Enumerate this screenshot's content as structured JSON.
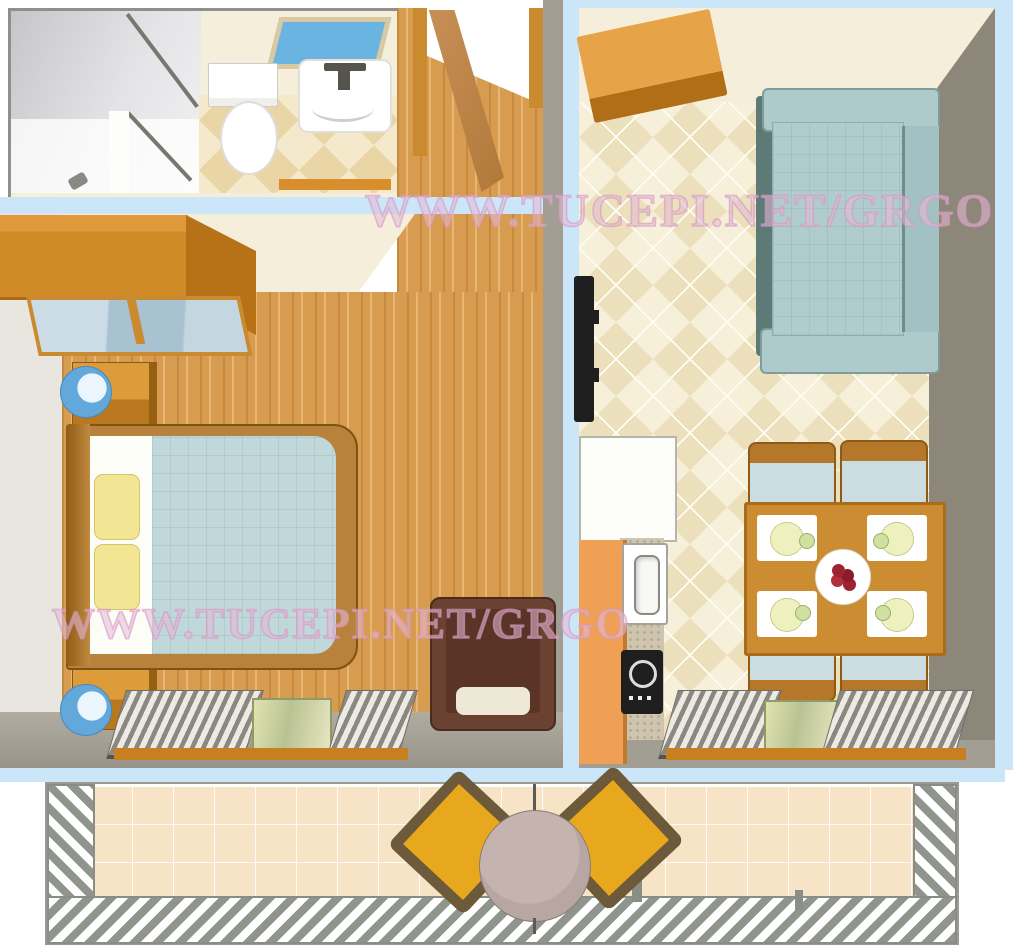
{
  "watermark": {
    "text": "WWW.TUCEPI.NET/GRGO"
  },
  "palette": {
    "blue-border": "#cbe6f8",
    "cream-wall": "#f4eedb",
    "pale-wall": "#e8e6df",
    "gray-wall": "#a29e94",
    "dark-wall": "#8d8779",
    "wood-floor": "#d89c50",
    "wood-furniture": "#c98a30",
    "tile-floor": "#ece0bc",
    "bath-tile": "#e9d5a6",
    "couch-teal": "#aecaca",
    "blanket-teal": "#c0d8da",
    "pillow-yellow": "#f2e694",
    "lamp-blue": "#63a8da",
    "skylight-blue": "#6ab4e2",
    "kitchen-orange": "#efa055",
    "armchair-brown": "#6b4232",
    "balcony-floor": "#f7e3c6",
    "patio-chair-yellow": "#e8a81e",
    "patio-chair-frame": "#6d5a3a",
    "patio-table-mauve": "#b7a6a2",
    "glass-green": "#cdd49e",
    "shutter-gray": "#8a8880",
    "appliance-black": "#1f1f1f",
    "plate-yellow": "#eef0be",
    "fruit-red": "#9e2330",
    "watermark-pink": "#d69ac4"
  }
}
